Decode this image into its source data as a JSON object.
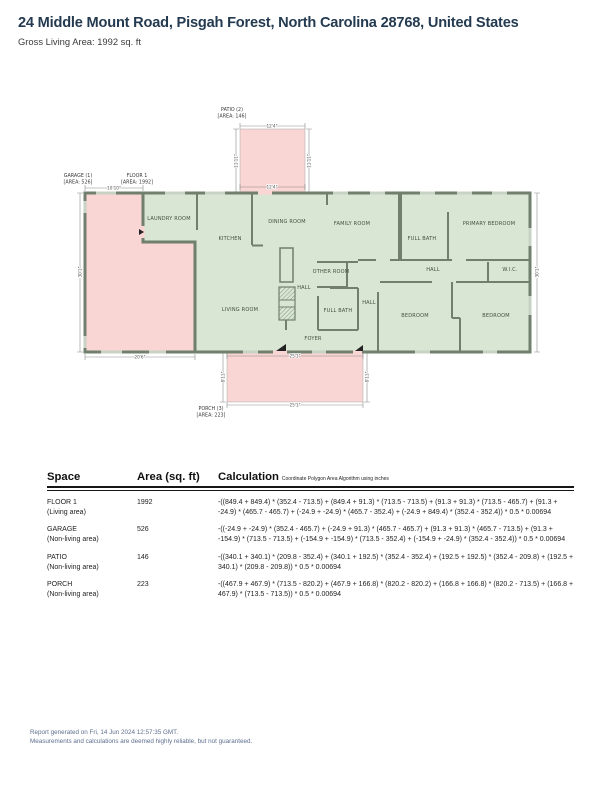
{
  "header": {
    "title": "24 Middle Mount Road, Pisgah Forest, North Carolina 28768, United States",
    "subtitle": "Gross Living Area: 1992 sq. ft"
  },
  "floorplan": {
    "colors": {
      "living_area_fill": "#d9e6d4",
      "non_living_area_fill": "#f9d5d3",
      "wall": "#707f6e",
      "window": "#c8d3c6",
      "dimension_line": "#8c8c8c"
    },
    "area_labels": [
      {
        "text": [
          "PATIO (2)",
          "[AREA: 146]"
        ],
        "x": 232,
        "y": 111
      },
      {
        "text": [
          "GARAGE (1)",
          "[AREA: 526]"
        ],
        "x": 78,
        "y": 177
      },
      {
        "text": [
          "FLOOR 1",
          "[AREA: 1992]"
        ],
        "x": 137,
        "y": 177
      },
      {
        "text": [
          "PORCH (3)",
          "[AREA: 223]"
        ],
        "x": 211,
        "y": 410
      }
    ],
    "room_labels": [
      {
        "text": "LAUNDRY ROOM",
        "x": 169,
        "y": 220,
        "rot": 0
      },
      {
        "text": "KITCHEN",
        "x": 230,
        "y": 240,
        "rot": 0
      },
      {
        "text": "DINING ROOM",
        "x": 287,
        "y": 223,
        "rot": 0
      },
      {
        "text": "FAMILY ROOM",
        "x": 352,
        "y": 225,
        "rot": 0
      },
      {
        "text": "FULL BATH",
        "x": 422,
        "y": 240,
        "rot": 0
      },
      {
        "text": "PRIMARY BEDROOM",
        "x": 489,
        "y": 225,
        "rot": 0
      },
      {
        "text": "OTHER ROOM",
        "x": 331,
        "y": 273,
        "rot": 0
      },
      {
        "text": "HALL",
        "x": 304,
        "y": 289,
        "rot": 0
      },
      {
        "text": "HALL",
        "x": 433,
        "y": 271,
        "rot": 0
      },
      {
        "text": "W.I.C.",
        "x": 510,
        "y": 271,
        "rot": 0
      },
      {
        "text": "LIVING ROOM",
        "x": 240,
        "y": 311,
        "rot": 0
      },
      {
        "text": "FULL BATH",
        "x": 338,
        "y": 312,
        "rot": 0
      },
      {
        "text": "HALL",
        "x": 369,
        "y": 304,
        "rot": 0
      },
      {
        "text": "FOYER",
        "x": 313,
        "y": 340,
        "rot": 0
      },
      {
        "text": "BEDROOM",
        "x": 415,
        "y": 317,
        "rot": 0
      },
      {
        "text": "BEDROOM",
        "x": 496,
        "y": 317,
        "rot": 0
      }
    ],
    "dim_labels": [
      {
        "text": "10'10\"",
        "x": 114,
        "y": 189.5,
        "rot": 0
      },
      {
        "text": "30'1\"",
        "x": 81.5,
        "y": 272,
        "rot": -90
      },
      {
        "text": "20'6\"",
        "x": 140,
        "y": 358.5,
        "rot": 0
      },
      {
        "text": "12'4\"",
        "x": 272,
        "y": 127.5,
        "rot": 0
      },
      {
        "text": "12'4\"",
        "x": 272,
        "y": 188.5,
        "rot": 0
      },
      {
        "text": "11'11\"",
        "x": 237.5,
        "y": 161,
        "rot": -90
      },
      {
        "text": "11'11\"",
        "x": 310.5,
        "y": 161,
        "rot": -90
      },
      {
        "text": "30'1\"",
        "x": 538.5,
        "y": 272,
        "rot": -90
      },
      {
        "text": "25'1\"",
        "x": 295,
        "y": 357.5,
        "rot": 0
      },
      {
        "text": "25'1\"",
        "x": 295,
        "y": 406.5,
        "rot": 0
      },
      {
        "text": "8'11\"",
        "x": 224.5,
        "y": 377,
        "rot": -90
      },
      {
        "text": "8'11\"",
        "x": 368.5,
        "y": 377,
        "rot": -90
      }
    ]
  },
  "table": {
    "headers": {
      "space": "Space",
      "area": "Area (sq. ft)",
      "calc": "Calculation",
      "calc_note": "Coordinate Polygon Area Algorithm using inches"
    },
    "rows": [
      {
        "name": "FLOOR 1",
        "type": "(Living area)",
        "area": "1992",
        "calc": "-((849.4 + 849.4) * (352.4 - 713.5) + (849.4 + 91.3) * (713.5 - 713.5) + (91.3 + 91.3) * (713.5 - 465.7) + (91.3 + -24.9) * (465.7 - 465.7) + (-24.9 + -24.9) * (465.7 - 352.4) + (-24.9 + 849.4) * (352.4 - 352.4)) * 0.5 * 0.00694"
      },
      {
        "name": "GARAGE",
        "type": "(Non-living area)",
        "area": "526",
        "calc": "-((-24.9 + -24.9) * (352.4 - 465.7) + (-24.9 + 91.3) * (465.7 - 465.7) + (91.3 + 91.3) * (465.7 - 713.5) + (91.3 + -154.9) * (713.5 - 713.5) + (-154.9 + -154.9) * (713.5 - 352.4) + (-154.9 + -24.9) * (352.4 - 352.4)) * 0.5 * 0.00694"
      },
      {
        "name": "PATIO",
        "type": "(Non-living area)",
        "area": "146",
        "calc": "-((340.1 + 340.1) * (209.8 - 352.4) + (340.1 + 192.5) * (352.4 - 352.4) + (192.5 + 192.5) * (352.4 - 209.8) + (192.5 + 340.1) * (209.8 - 209.8)) * 0.5 * 0.00694"
      },
      {
        "name": "PORCH",
        "type": "(Non-living area)",
        "area": "223",
        "calc": "-((467.9 + 467.9) * (713.5 - 820.2) + (467.9 + 166.8) * (820.2 - 820.2) + (166.8 + 166.8) * (820.2 - 713.5) + (166.8 + 467.9) * (713.5 - 713.5)) * 0.5 * 0.00694"
      }
    ]
  },
  "footer": {
    "line1": "Report generated on Fri, 14 Jun 2024 12:57:35 GMT.",
    "line2": "Measurements and calculations are deemed highly reliable, but not guaranteed."
  }
}
